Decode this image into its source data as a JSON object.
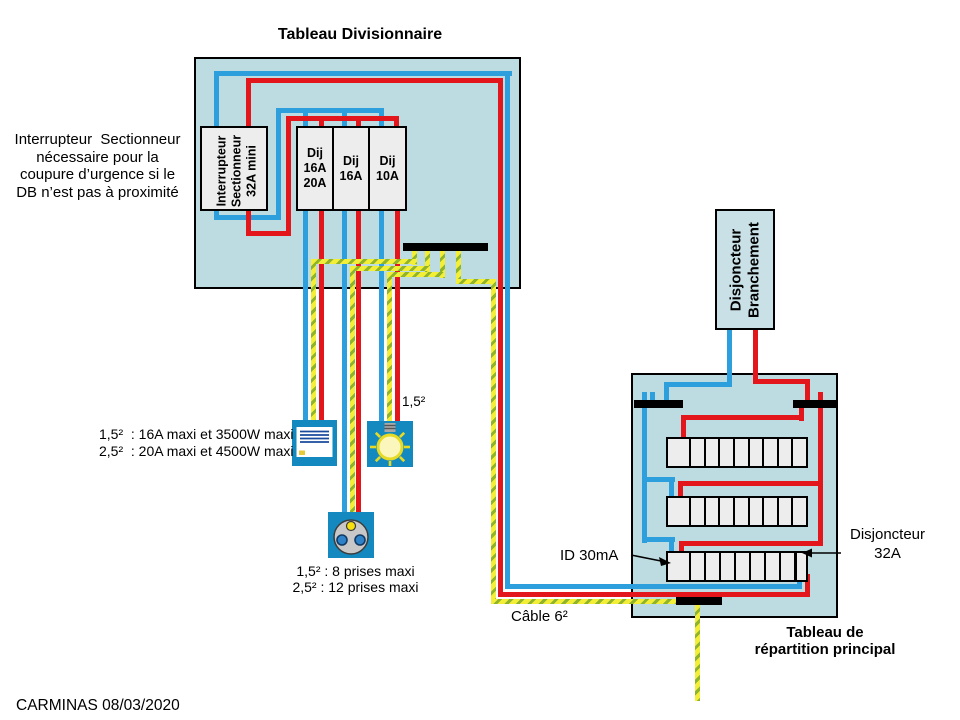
{
  "titles": {
    "divisionnaire": "Tableau Divisionnaire",
    "principal_l1": "Tableau de",
    "principal_l2": "répartition principal"
  },
  "notes": {
    "left_l1": "Interrupteur  Sectionneur",
    "left_l2": "nécessaire pour la",
    "left_l3": "coupure d’urgence si le",
    "left_l4": "DB n’est pas à proximité",
    "maxi_l1": "1,5²  : 16A maxi et 3500W maxi",
    "maxi_l2": "2,5²  : 20A maxi et 4500W maxi",
    "prises_l1": "1,5² : 8 prises maxi",
    "prises_l2": "2,5² : 12 prises maxi",
    "section_label": "1,5²",
    "cable_label": "Câble 6²",
    "footer": "CARMINAS 08/03/2020"
  },
  "components": {
    "interrupteur": {
      "l1": "Interrupteur",
      "l2": "Sectionneur",
      "l3": "32A mini"
    },
    "breakers": [
      {
        "l1": "Dij",
        "l2": "16A",
        "l3": "20A"
      },
      {
        "l1": "Dij",
        "l2": "16A",
        "l3": ""
      },
      {
        "l1": "Dij",
        "l2": "10A",
        "l3": ""
      }
    ],
    "db": {
      "l1": "Disjoncteur",
      "l2": "Branchement"
    },
    "id_label": "ID 30mA",
    "dj32_l1": "Disjoncteur",
    "dj32_l2": "32A"
  },
  "icons": {
    "heater": "heater-icon",
    "bulb": "light-bulb-icon",
    "socket": "socket-outlet-icon"
  },
  "colors": {
    "panel_fill": "#bcdce2",
    "wire_neutral_blue": "#2e9fdd",
    "wire_phase_red": "#e3161b",
    "earth_yellow": "#f3ef39",
    "earth_green": "#8fb32a",
    "device_teal": "#1389bf",
    "module_fill": "#ededed",
    "bar_black": "#000000"
  }
}
